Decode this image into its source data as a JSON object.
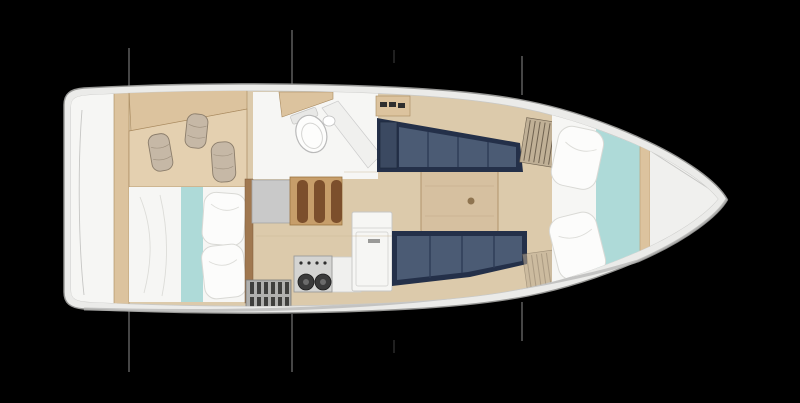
{
  "scene": {
    "kind": "sailing-yacht-interior-floor-plan",
    "view": "top-down",
    "orientation": "bow-right-stern-left",
    "visible_text": []
  },
  "palette": {
    "background": "#000000",
    "hull_deck": "#ebebe9",
    "hull_outline": "#979795",
    "hull_shadow": "#b6b6b4",
    "floor_wood": "#dccaab",
    "wood_panel": "#e4d0b0",
    "wood_plank": "#dcc39e",
    "wood_edge": "#a8895e",
    "divider_wood": "#a07850",
    "table_wood": "#d6c0a0",
    "table_edge": "#b1946c",
    "step_wood": "#c79e6a",
    "step_edge": "#9a7340",
    "tread": "#7c4f2c",
    "navy_frame": "#243049",
    "navy_cushion": "#4b5b74",
    "navy_back": "#3b4961",
    "navy_seam": "#2c3a54",
    "teal": "#aedad8",
    "white_surface": "#f6f6f4",
    "off_white": "#f0f0ee",
    "pillow": "#fcfcfb",
    "pillow_edge": "#d9d9d5",
    "gray_box": "#c9c9c9",
    "gray_box_edge": "#a6a6a6",
    "stove_panel": "#d4d4d2",
    "stove_edge": "#9c9c9a",
    "burner": "#3a3a3a",
    "grate": "#b0b0ae",
    "grate_edge": "#7b7b79",
    "grate_slat": "#3f3f3d",
    "fender": "#c6b8a6",
    "fender_edge": "#8b7d6b",
    "stay": "#8c8c8c",
    "bow_shade": "#d9d9d7"
  },
  "regions": [
    "transom-platform",
    "stern-locker-fenders",
    "aft-cabin-berth",
    "head-compartment",
    "companionway-steps",
    "galley-stove",
    "galley-counter",
    "refrigerator-cabinet",
    "engine-hatch-grating",
    "saloon-table",
    "port-settee",
    "starboard-settee",
    "louvered-locker",
    "v-berth",
    "bow-deck",
    "rigging-stay-lines"
  ]
}
